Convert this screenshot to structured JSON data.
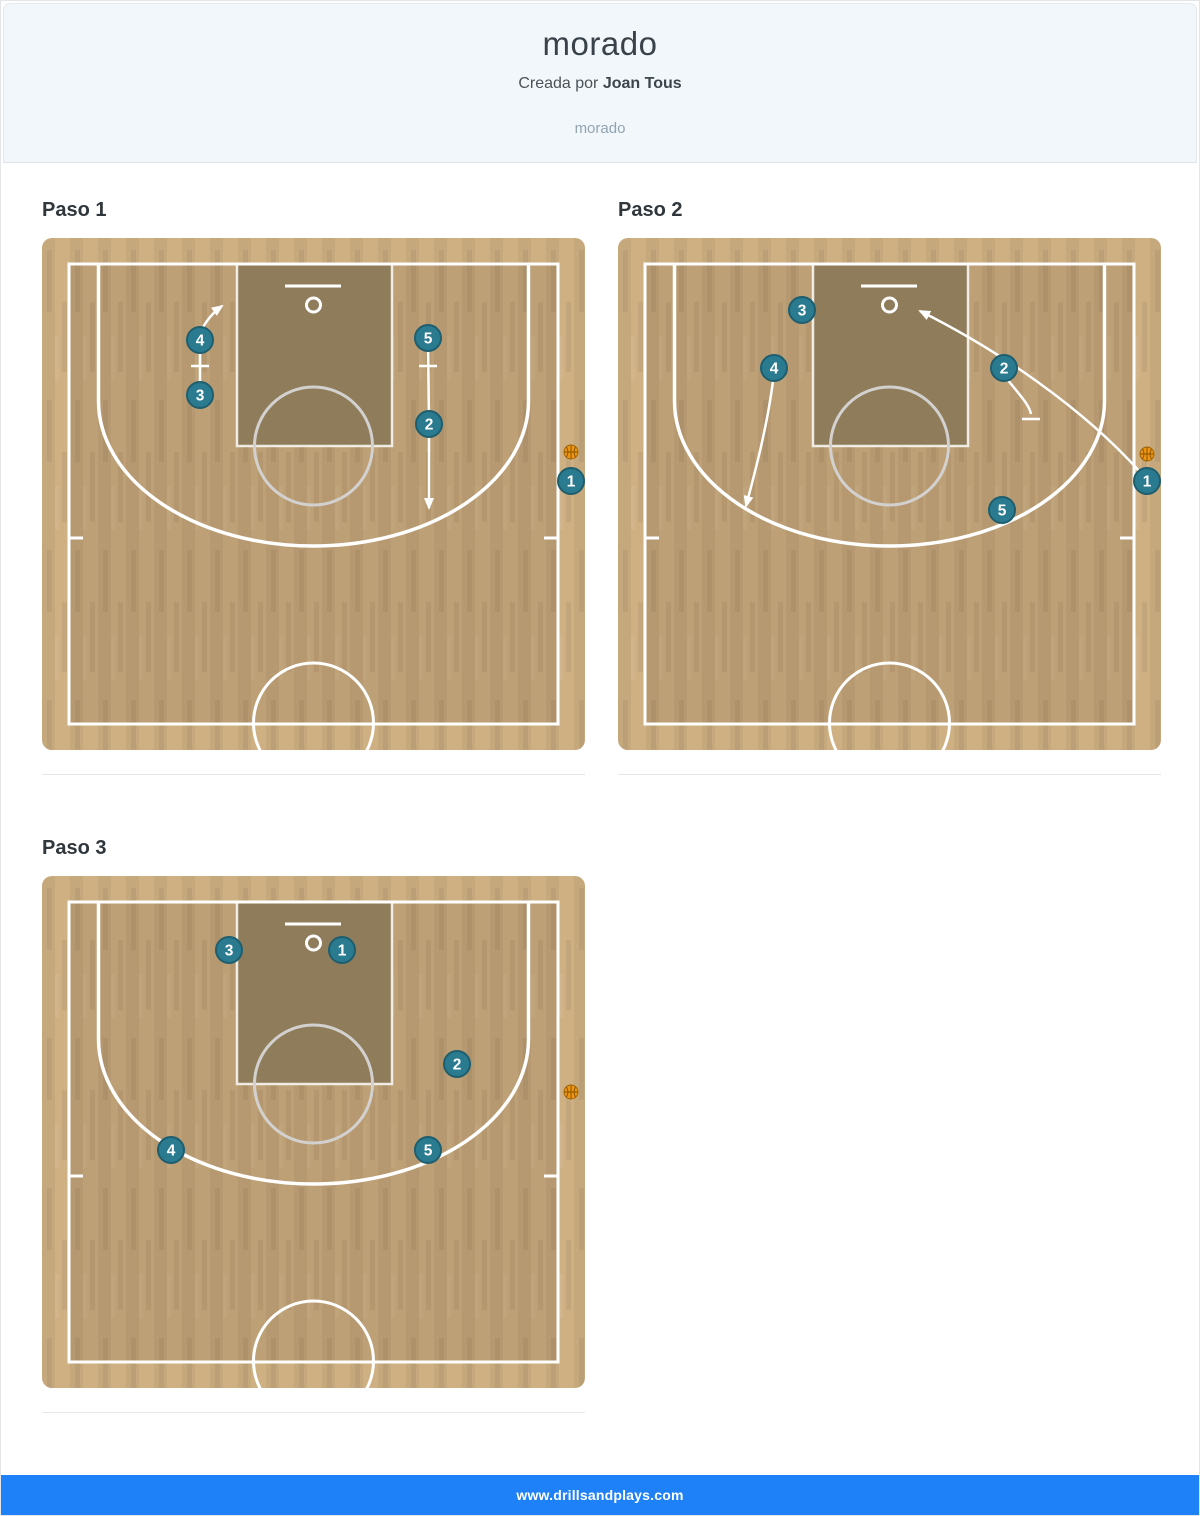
{
  "header": {
    "title": "morado",
    "created_by_prefix": "Creada por",
    "author": "Joan Tous",
    "subtitle": "morado"
  },
  "footer": {
    "url": "www.drillsandplays.com"
  },
  "colors": {
    "header_bg": "#f1f7fa",
    "footer_blue": "#1e81f8",
    "court_base": "#cfb083",
    "court_interior_shade": "rgba(82,62,34,0.14)",
    "key_fill": "#8f7c5a",
    "key_stroke": "rgba(248,246,242,0.9)",
    "line_white": "#ffffff",
    "ft_circle_gray": "#d3d1cf",
    "marker_fill": "#2a7b90",
    "marker_border": "#1e5e6f",
    "marker_text": "#ffffff",
    "ball_fill": "#ee9511",
    "ball_stroke": "#a16503",
    "ball_seam": "#8a5403"
  },
  "court": {
    "width": 543,
    "height": 512,
    "radius": 10,
    "boundary": [
      27,
      26,
      516,
      486
    ],
    "key": [
      195,
      26,
      155,
      182
    ],
    "backboard": [
      243,
      48,
      299,
      48
    ],
    "rim": [
      271.5,
      67,
      7
    ],
    "ft_circle": [
      271.5,
      208,
      59
    ],
    "three_point": {
      "corner_x": [
        56.5,
        486.5
      ],
      "top_y": 26,
      "break_y": 163,
      "rx": 215,
      "ry": 145
    },
    "center_circle": [
      271.5,
      485,
      60
    ],
    "hash_y": 300,
    "hash_len": 14,
    "marker_radius": 13,
    "ball_radius": 7
  },
  "steps": [
    {
      "label": "Paso 1",
      "markers": [
        {
          "n": "4",
          "x": 158,
          "y": 102
        },
        {
          "n": "3",
          "x": 158,
          "y": 157
        },
        {
          "n": "5",
          "x": 386,
          "y": 100
        },
        {
          "n": "2",
          "x": 387,
          "y": 186
        },
        {
          "n": "1",
          "x": 529,
          "y": 243
        }
      ],
      "ball": {
        "x": 529,
        "y": 214
      },
      "screens": [
        {
          "d": "M158,157 L158,102",
          "bar": [
            149,
            128,
            167,
            128
          ]
        },
        {
          "d": "M386,100 L387,186",
          "bar": [
            377,
            128,
            395,
            128
          ]
        }
      ],
      "arrows": [
        {
          "d": "M158,95 Q166,78 180,68"
        },
        {
          "d": "M387,199 L387,270"
        }
      ]
    },
    {
      "label": "Paso 2",
      "markers": [
        {
          "n": "3",
          "x": 184,
          "y": 72
        },
        {
          "n": "4",
          "x": 156,
          "y": 130
        },
        {
          "n": "2",
          "x": 386,
          "y": 130
        },
        {
          "n": "5",
          "x": 384,
          "y": 272
        },
        {
          "n": "1",
          "x": 529,
          "y": 243
        }
      ],
      "ball": {
        "x": 529,
        "y": 216
      },
      "screens": [
        {
          "d": "M389,141 C400,155 411,166 413,176",
          "bar": [
            404,
            181,
            422,
            181
          ]
        }
      ],
      "arrows": [
        {
          "d": "M155,143 C149,190 136,238 128,268"
        },
        {
          "d": "M522,234 C465,170 380,112 302,73"
        }
      ]
    },
    {
      "label": "Paso 3",
      "markers": [
        {
          "n": "3",
          "x": 187,
          "y": 74
        },
        {
          "n": "1",
          "x": 300,
          "y": 74
        },
        {
          "n": "2",
          "x": 415,
          "y": 188
        },
        {
          "n": "4",
          "x": 129,
          "y": 274
        },
        {
          "n": "5",
          "x": 386,
          "y": 274
        }
      ],
      "ball": {
        "x": 529,
        "y": 216
      },
      "screens": [],
      "arrows": []
    }
  ]
}
